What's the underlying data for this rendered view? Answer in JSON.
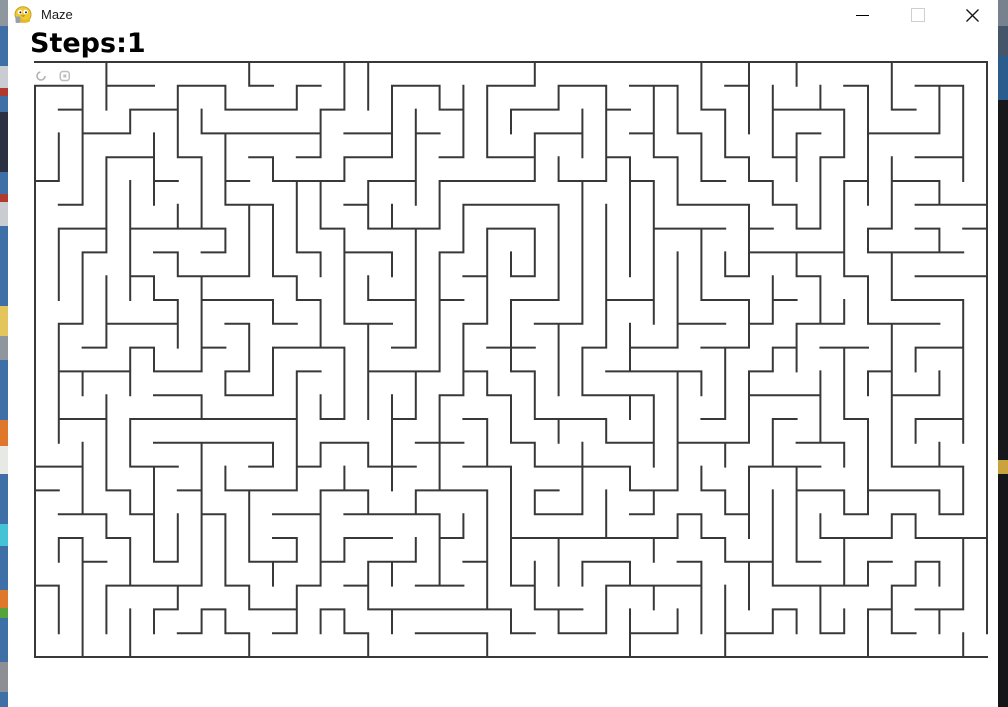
{
  "window": {
    "title": "Maze",
    "icon": "pygame-snake",
    "controls": {
      "minimize": "minimize",
      "maximize": "maximize",
      "close": "close",
      "maximize_enabled": false
    }
  },
  "hud": {
    "steps_text": "Steps:1",
    "steps_value": 1
  },
  "maze": {
    "cols": 40,
    "rows": 25,
    "cell_px": 23.8,
    "origin_x": 27,
    "origin_y": 62,
    "wall_color": "#383838",
    "wall_px": 2,
    "background": "#ffffff",
    "seed": 7,
    "entrance": {
      "side": "left",
      "row": 0
    },
    "exit": {
      "side": "right",
      "row": 24
    },
    "sprites": [
      {
        "name": "player-sprite",
        "shape": "open-ring",
        "col": 0,
        "row": 0,
        "color": "#b2b2b2"
      },
      {
        "name": "marker-sprite",
        "shape": "rounded-square",
        "col": 1,
        "row": 0,
        "color": "#bdbdbd"
      }
    ]
  },
  "desktop": {
    "left_strip": {
      "base_color": "#3e6fa6",
      "segments": [
        {
          "h": 26,
          "c": "#8e979e"
        },
        {
          "h": 40,
          "c": "#3e6fa6"
        },
        {
          "h": 22,
          "c": "#c9cdd1"
        },
        {
          "h": 8,
          "c": "#b03a2e"
        },
        {
          "h": 16,
          "c": "#3e6fa6"
        },
        {
          "h": 60,
          "c": "#2b3142"
        },
        {
          "h": 22,
          "c": "#3e6fa6"
        },
        {
          "h": 8,
          "c": "#b03a2e"
        },
        {
          "h": 24,
          "c": "#c9cdd1"
        },
        {
          "h": 80,
          "c": "#3e6fa6"
        },
        {
          "h": 30,
          "c": "#e3c55c"
        },
        {
          "h": 24,
          "c": "#8e979e"
        },
        {
          "h": 60,
          "c": "#3e6fa6"
        },
        {
          "h": 26,
          "c": "#e0782c"
        },
        {
          "h": 28,
          "c": "#e7eae4"
        },
        {
          "h": 50,
          "c": "#3e6fa6"
        },
        {
          "h": 22,
          "c": "#44c3d6"
        },
        {
          "h": 44,
          "c": "#3e6fa6"
        },
        {
          "h": 18,
          "c": "#e0782c"
        },
        {
          "h": 10,
          "c": "#55a33a"
        },
        {
          "h": 44,
          "c": "#3e6fa6"
        },
        {
          "h": 30,
          "c": "#8e8f94"
        }
      ]
    },
    "right_strip": {
      "base_color": "#141619",
      "segments": [
        {
          "h": 26,
          "c": "#78828e"
        },
        {
          "h": 30,
          "c": "#46566a"
        },
        {
          "h": 44,
          "c": "#2a5c8e"
        },
        {
          "h": 360,
          "c": "#17181b"
        },
        {
          "h": 14,
          "c": "#c9a43e"
        }
      ]
    }
  }
}
